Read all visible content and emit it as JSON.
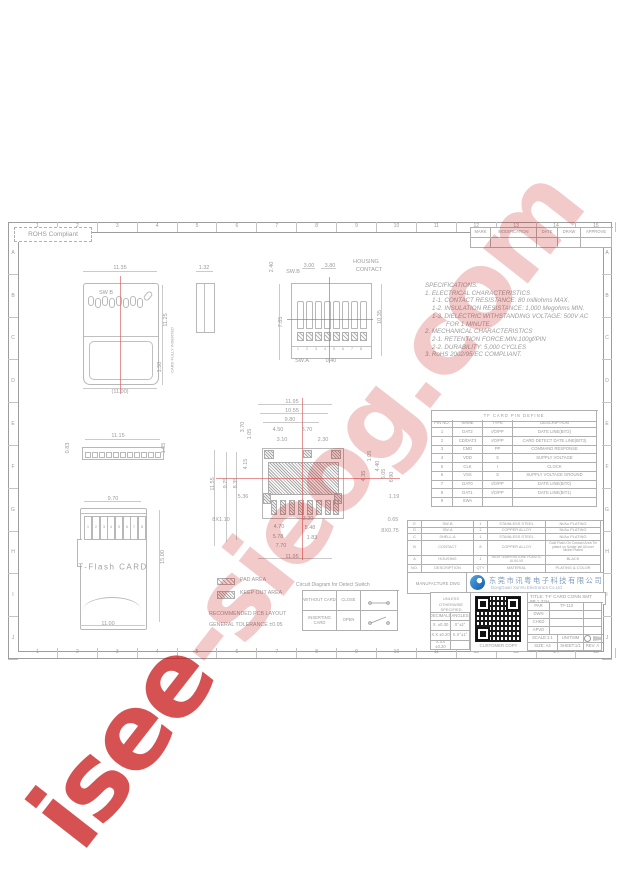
{
  "watermark": {
    "word1": "isee",
    "word2": "-sieog.com"
  },
  "sheet": {
    "rohs_label": "ROHS Compliant",
    "top_numbers": [
      "1",
      "2",
      "3",
      "4",
      "5",
      "6",
      "7",
      "8",
      "9",
      "10",
      "11",
      "12",
      "13",
      "14",
      "15"
    ],
    "side_letters": [
      "A",
      "B",
      "C",
      "D",
      "E",
      "F",
      "G",
      "H",
      "I",
      "J"
    ]
  },
  "revision_table": {
    "headers": [
      "MARK",
      "MODIFICATION",
      "DATE",
      "DRAW",
      "APPROVE"
    ]
  },
  "specifications": {
    "lines": [
      {
        "t": "SPECIFICATIONS:",
        "i": 0
      },
      {
        "t": "1. ELECTRICAL CHARACTERISTICS",
        "i": 0
      },
      {
        "t": "1-1. CONTACT RESISTANCE: 80 milliohms MAX.",
        "i": 1
      },
      {
        "t": "1-2. INSULATION RESISTANCE: 1,000 Megohms MIN.",
        "i": 1
      },
      {
        "t": "1-3. DIELECTRIC WITHSTANDING VOLTAGE: 500V AC",
        "i": 1
      },
      {
        "t": "FOR 1 MINUTE.",
        "i": 3
      },
      {
        "t": "2. MECHANICAL CHARACTERISTICS",
        "i": 0
      },
      {
        "t": "2-1. RETENTION FORCE:MIN.100gf/PIN",
        "i": 1
      },
      {
        "t": "2-2. DURABILITY: 5,000 CYCLES",
        "i": 1
      },
      {
        "t": "3. RoHS 2002/95/EC COMPLIANT.",
        "i": 0
      }
    ]
  },
  "pin_table": {
    "title": "TF CARD PIN DEFINE",
    "headers": [
      "PIN NO.",
      "NAME",
      "TYPE",
      "DESCRIPTION"
    ],
    "rows": [
      [
        "1",
        "DAT2",
        "I/O/PP",
        "DATE LINE(BIT2)"
      ],
      [
        "2",
        "CD/DAT3",
        "I/O/PP",
        "CARD DETECT DATE LINE(BIT3)"
      ],
      [
        "3",
        "CMD",
        "PP",
        "COMMAND RESPONSE"
      ],
      [
        "4",
        "VDD",
        "S",
        "SUPPLY VOLTAGE"
      ],
      [
        "5",
        "CLK",
        "I",
        "CLOCK"
      ],
      [
        "6",
        "VSS",
        "S",
        "SUPPLY VOLTAGE GROUND"
      ],
      [
        "7",
        "DAT0",
        "I/O/PP",
        "DATE LINE(BIT0)"
      ],
      [
        "8",
        "DAT1",
        "I/O/PP",
        "DATE LINE(BIT1)"
      ],
      [
        "9",
        "SWA",
        "",
        ""
      ]
    ]
  },
  "material_table": {
    "rows": [
      [
        "E",
        "SW-B",
        "1",
        "STAINLESS STEEL",
        "Ni/Au PLATING"
      ],
      [
        "D",
        "SW-A",
        "1",
        "COPPER ALLOY",
        "Ni/Au PLATING"
      ],
      [
        "C",
        "SHELL-A",
        "1",
        "STAINLESS STEEL",
        "Ni/Au PLATING"
      ],
      [
        "B",
        "CONTACT",
        "8",
        "COPPER ALLOY",
        "Gold Flash On Contact Area Tin plated on Solder tail All over Nickel Plated"
      ],
      [
        "A",
        "HOUSING",
        "1",
        "HIGH TEMPERATURE PLASTIC UL94-V0",
        "BLACK"
      ],
      [
        "NO.",
        "DESCRIPTION",
        "QTY",
        "MATERIAL",
        "PLATING & COLOR"
      ]
    ]
  },
  "manufacture": {
    "label": "MANUFACTURE DWG",
    "company_cn": "东莞市讯粤电子科技有限公司",
    "company_en": "DongGuan XunYu Electronics Co.Ltd"
  },
  "title_block": {
    "tolerance_note1": "UNLESS OTHERWISE",
    "tolerance_note2": "SPECIFIED TOLERANCES",
    "tolerance_table": {
      "headers": [
        "DECIMALS",
        "ANGLES"
      ],
      "rows": [
        [
          "X. ±0.30",
          "X°±2°"
        ],
        [
          "X.X ±0.20",
          "X.X°±1°"
        ],
        [
          "X.XX ±0.20",
          ""
        ]
      ]
    },
    "customer_copy": "CUSTOMER COPY",
    "title_line1": "TITLE: T-F CARD CONN SMT",
    "title_line2": "9P 1.32H",
    "info_rows": [
      [
        "PAR",
        "TF-110"
      ],
      [
        "DWN",
        ""
      ],
      [
        "CHKD",
        ""
      ],
      [
        "APVD",
        ""
      ]
    ],
    "scale": "SCALE:1:1",
    "unit": "UNIT:MM",
    "size": "SIZE: A4",
    "sheet_no": "SHEET:1/1",
    "rev": "REV: A"
  },
  "legend": {
    "pad_area": "PAD AREA",
    "keep_out": "KEEP OUT AREA",
    "line1": "RECOMMENDED PCB LAYOUT",
    "line2": "GENERAL TOLERANCE ±0.05"
  },
  "detect_switch": {
    "title": "Circuit Diagram for Detect Switch",
    "rows": [
      [
        "WITHOUT CARD",
        "CLOSE"
      ],
      [
        "INSERTING CARD",
        "OPEN"
      ]
    ]
  },
  "drawing": {
    "dims": [
      {
        "t": "11.35",
        "x": 120,
        "y": 268
      },
      {
        "t": "1.32",
        "x": 204,
        "y": 268
      },
      {
        "t": "SW B",
        "x": 106,
        "y": 293
      },
      {
        "t": "11.25",
        "x": 166,
        "y": 320,
        "r": -90
      },
      {
        "t": "1.50",
        "x": 160,
        "y": 367,
        "r": -90
      },
      {
        "t": "CARD FULLY INSERTED",
        "x": 172,
        "y": 350,
        "r": -90,
        "c": "tiny"
      },
      {
        "t": "(11.00)",
        "x": 120,
        "y": 392
      },
      {
        "t": "2.40",
        "x": 272,
        "y": 267,
        "r": -90
      },
      {
        "t": "SW.B",
        "x": 293,
        "y": 272
      },
      {
        "t": "3.00",
        "x": 309,
        "y": 266
      },
      {
        "t": "3.80",
        "x": 330,
        "y": 266
      },
      {
        "t": "HOUSING",
        "x": 366,
        "y": 262
      },
      {
        "t": "CONTACT",
        "x": 369,
        "y": 270
      },
      {
        "t": "7.85",
        "x": 281,
        "y": 322,
        "r": -90
      },
      {
        "t": "10.35",
        "x": 380,
        "y": 317,
        "r": -90
      },
      {
        "t": "SW.A",
        "x": 302,
        "y": 361
      },
      {
        "t": "0.40",
        "x": 331,
        "y": 361
      },
      {
        "t": "1",
        "x": 298,
        "y": 349,
        "c": "t2"
      },
      {
        "t": "2",
        "x": 307,
        "y": 349,
        "c": "t2"
      },
      {
        "t": "3",
        "x": 316,
        "y": 349,
        "c": "t2"
      },
      {
        "t": "4",
        "x": 325,
        "y": 349,
        "c": "t2"
      },
      {
        "t": "5",
        "x": 334,
        "y": 349,
        "c": "t2"
      },
      {
        "t": "6",
        "x": 343,
        "y": 349,
        "c": "t2"
      },
      {
        "t": "7",
        "x": 352,
        "y": 349,
        "c": "t2"
      },
      {
        "t": "8",
        "x": 361,
        "y": 349,
        "c": "t2"
      },
      {
        "t": "0.83",
        "x": 68,
        "y": 448,
        "r": -90
      },
      {
        "t": "11.15",
        "x": 118,
        "y": 436
      },
      {
        "t": "1.05",
        "x": 164,
        "y": 448,
        "r": -90
      },
      {
        "t": "11.95",
        "x": 292,
        "y": 402
      },
      {
        "t": "10.55",
        "x": 292,
        "y": 411
      },
      {
        "t": "9.80",
        "x": 290,
        "y": 420
      },
      {
        "t": "4.50",
        "x": 278,
        "y": 430
      },
      {
        "t": "3.70",
        "x": 307,
        "y": 430
      },
      {
        "t": "3.10",
        "x": 282,
        "y": 440
      },
      {
        "t": "2.30",
        "x": 323,
        "y": 440
      },
      {
        "t": "3.70",
        "x": 243,
        "y": 427,
        "r": -90
      },
      {
        "t": "1.05",
        "x": 250,
        "y": 434,
        "r": -90
      },
      {
        "t": "4.15",
        "x": 246,
        "y": 464,
        "r": -90
      },
      {
        "t": "11.55",
        "x": 213,
        "y": 484,
        "r": -90
      },
      {
        "t": "9.75",
        "x": 226,
        "y": 483,
        "r": -90
      },
      {
        "t": "8.35",
        "x": 236,
        "y": 483,
        "r": -90
      },
      {
        "t": "5.36",
        "x": 243,
        "y": 497
      },
      {
        "t": "1.05",
        "x": 370,
        "y": 456,
        "r": -90
      },
      {
        "t": "4.40",
        "x": 378,
        "y": 466,
        "r": -90
      },
      {
        "t": "4.35",
        "x": 364,
        "y": 476,
        "r": -90
      },
      {
        "t": "6.05",
        "x": 384,
        "y": 474,
        "r": -90
      },
      {
        "t": "6.90",
        "x": 392,
        "y": 477,
        "r": -90
      },
      {
        "t": "1.19",
        "x": 394,
        "y": 497
      },
      {
        "t": "8X1.10",
        "x": 221,
        "y": 520
      },
      {
        "t": "3.20",
        "x": 308,
        "y": 519
      },
      {
        "t": "0.65",
        "x": 393,
        "y": 520
      },
      {
        "t": "4.70",
        "x": 279,
        "y": 527
      },
      {
        "t": "5.48",
        "x": 310,
        "y": 528
      },
      {
        "t": "8X0.75",
        "x": 390,
        "y": 531
      },
      {
        "t": "5.78",
        "x": 278,
        "y": 537
      },
      {
        "t": "1.83",
        "x": 312,
        "y": 538
      },
      {
        "t": "7.70",
        "x": 281,
        "y": 546
      },
      {
        "t": "11.95",
        "x": 292,
        "y": 557
      },
      {
        "t": "9.70",
        "x": 113,
        "y": 499
      },
      {
        "t": "15.00",
        "x": 163,
        "y": 557,
        "r": -90
      },
      {
        "t": "11.00",
        "x": 108,
        "y": 624
      },
      {
        "t": "T-Flash CARD",
        "x": 113,
        "y": 567,
        "c": "big"
      },
      {
        "t": "1",
        "x": 88,
        "y": 527,
        "c": "t2"
      },
      {
        "t": "2",
        "x": 96,
        "y": 527,
        "c": "t2"
      },
      {
        "t": "3",
        "x": 104,
        "y": 527,
        "c": "t2"
      },
      {
        "t": "4",
        "x": 111,
        "y": 527,
        "c": "t2"
      },
      {
        "t": "5",
        "x": 119,
        "y": 527,
        "c": "t2"
      },
      {
        "t": "6",
        "x": 127,
        "y": 527,
        "c": "t2"
      },
      {
        "t": "7",
        "x": 134,
        "y": 527,
        "c": "t2"
      },
      {
        "t": "8",
        "x": 142,
        "y": 527,
        "c": "t2"
      }
    ]
  }
}
